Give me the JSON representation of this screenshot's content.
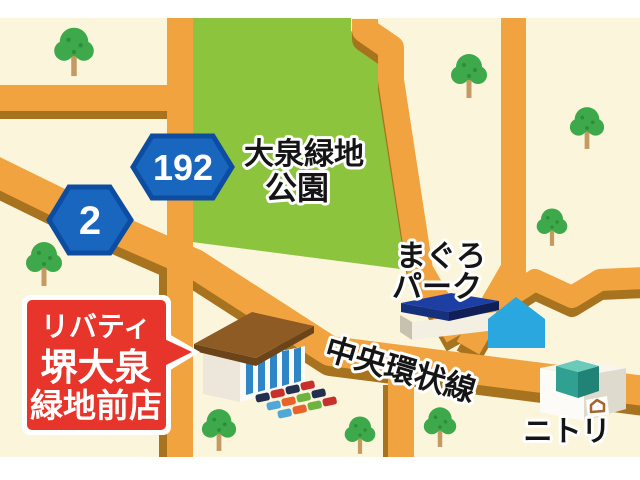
{
  "labels": {
    "park": {
      "line1": "大泉緑地",
      "line2": "公園"
    },
    "maguro_park": {
      "line1": "まぐろ",
      "line2": "パーク"
    },
    "road": "中央環状線",
    "nitori": "ニトリ"
  },
  "signs": {
    "route_192": "192",
    "route_2": "2"
  },
  "callout": {
    "line1": "リバティ",
    "line2": "堺大泉",
    "line3": "緑地前店"
  },
  "colors": {
    "page_margin": "#FFFFFF",
    "map_ground": "#FBF5DC",
    "park_green": "#8CC43D",
    "road_orange": "#F0A33E",
    "road_shadow": "#A8731E",
    "sign_blue": "#1866BE",
    "sign_border": "#0C4DA2",
    "callout_red": "#E7352B",
    "water_blue": "#2AA7DE",
    "tree_green": "#3DA94A",
    "label_black": "#151515"
  }
}
